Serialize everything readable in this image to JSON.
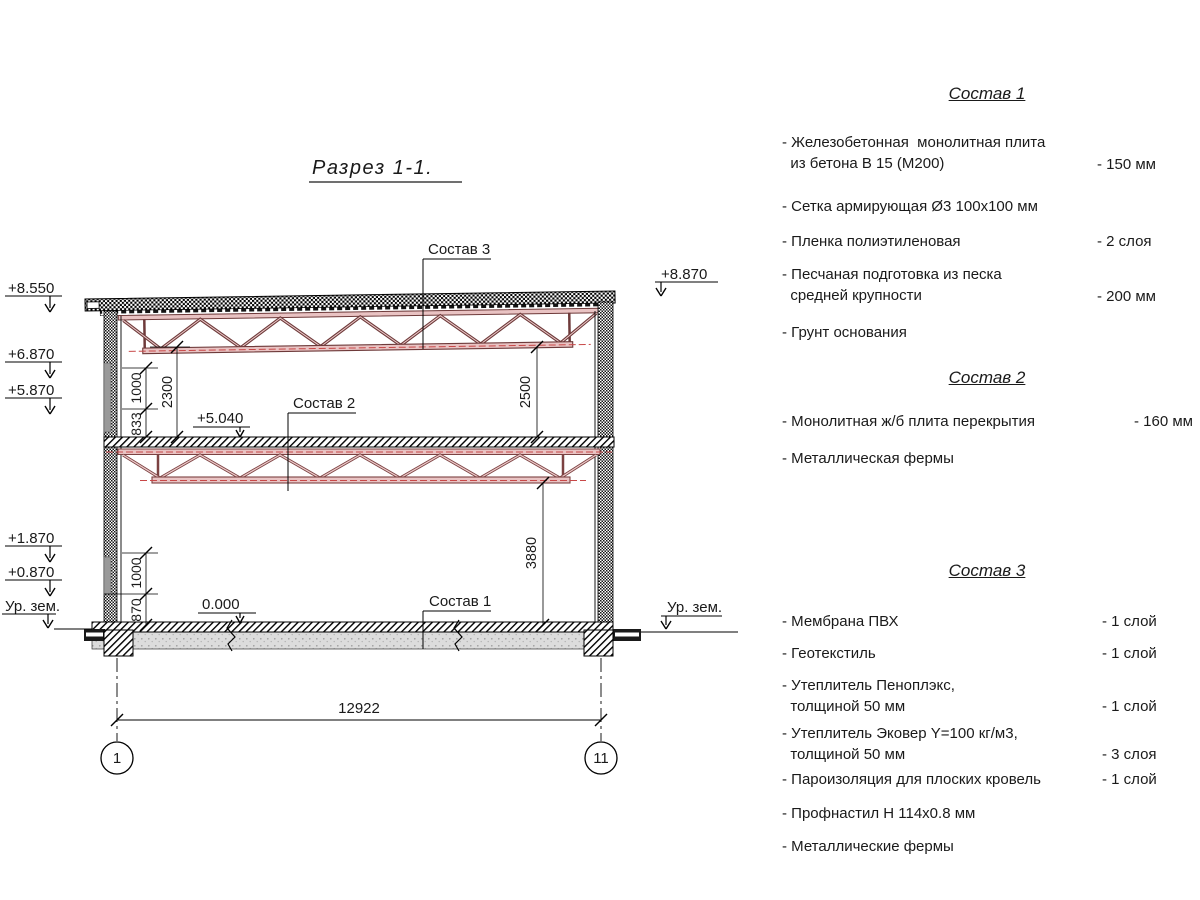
{
  "title": "Разрез 1-1.",
  "colors": {
    "truss_dark": "#6e3a3a",
    "truss_mid": "#7c4242",
    "truss_light": "#e9c3c3",
    "centerline_red": "#c84848",
    "wall_glazing_gray": "#9a9a9a",
    "floor_gray": "#dcdcdc"
  },
  "section_view": {
    "elevations_left": [
      {
        "label": "+8.550"
      },
      {
        "label": "+6.870"
      },
      {
        "label": "+5.870"
      },
      {
        "label": "+1.870"
      },
      {
        "label": "+0.870"
      },
      {
        "label": "Ур. зем."
      }
    ],
    "elevations_right": [
      {
        "label": "+8.870"
      },
      {
        "label": "Ур. зем."
      }
    ],
    "callouts": {
      "sostav1": "Состав 1",
      "sostav2": "Состав 2",
      "sostav3": "Состав 3",
      "level_mid": "+5.040",
      "level_zero": "0.000"
    },
    "dimensions": {
      "span": "12922",
      "roof_offset": "2300",
      "upper_a": "1000",
      "upper_b": "833",
      "lower_a": "1000",
      "lower_b": "870",
      "clear_top": "2500",
      "clear_bot": "3880"
    },
    "axes": [
      {
        "label": "1"
      },
      {
        "label": "11"
      }
    ]
  },
  "legend": {
    "sections": [
      {
        "header": "Состав 1",
        "items": [
          {
            "label": "- Железобетонная  монолитная плита\n  из бетона В 15 (М200)",
            "value": "- 150 мм"
          },
          {
            "label": "- Сетка армирующая Ø3 100x100 мм",
            "value": ""
          },
          {
            "label": "- Пленка полиэтиленовая",
            "value": "-  2 слоя"
          },
          {
            "label": "- Песчаная подготовка из песка\n  средней крупности",
            "value": "- 200 мм"
          },
          {
            "label": "- Грунт основания",
            "value": ""
          }
        ]
      },
      {
        "header": "Состав 2",
        "items": [
          {
            "label": "- Монолитная ж/б плита перекрытия",
            "value": "- 160 мм"
          },
          {
            "label": "- Металлическая фермы",
            "value": ""
          }
        ]
      },
      {
        "header": "Состав 3",
        "items": [
          {
            "label": "- Мембрана ПВХ",
            "value": "- 1 слой"
          },
          {
            "label": "- Геотекстиль",
            "value": "- 1 слой"
          },
          {
            "label": "- Утеплитель Пеноплэкс,\n  толщиной 50 мм",
            "value": "- 1 слой"
          },
          {
            "label": "- Утеплитель Эковер Y=100 кг/м3,\n  толщиной 50 мм",
            "value": "- 3 слоя"
          },
          {
            "label": "- Пароизоляция для плоских кровель",
            "value": "- 1 слой"
          },
          {
            "label": "- Профнастил Н 114x0.8 мм",
            "value": ""
          },
          {
            "label": "- Металлические фермы",
            "value": ""
          }
        ]
      }
    ]
  }
}
